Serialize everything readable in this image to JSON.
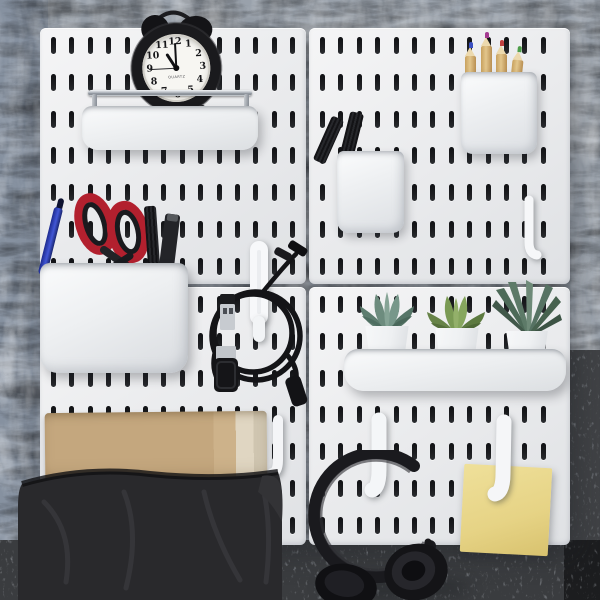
{
  "meta": {
    "title": "White pegboard wall organizer — styled product photo",
    "scene": "2x2 white slotted pegboard panels mounted on a textured gray wall above a gray carpeted floor"
  },
  "palette": {
    "wall": "#99a1ab",
    "wallLeft": "#8691a0",
    "floor": "#83878d",
    "panel": "#ebecee",
    "panelHi": "#f5f5f6",
    "panelLo": "#dfe1e4",
    "slot": "#1d1e21",
    "chrome": "#aeb4bb",
    "scissorRed": "#b2202e",
    "penBlue": "#2c3db0",
    "kraft": "#c4a77e",
    "bag": "#29292c",
    "note": "#e6d385",
    "plantGray": "#6d8c7e",
    "plantYellowGreen": "#7a9a54",
    "plantDark": "#4d6a58",
    "black": "#17181b",
    "white": "#f6f7f9"
  },
  "clock": {
    "numerals": [
      "12",
      "1",
      "2",
      "3",
      "4",
      "5",
      "6",
      "7",
      "8",
      "9",
      "10",
      "11"
    ],
    "brand": "QUARTZ",
    "time": {
      "hour": 11,
      "minute": 0,
      "second": 45
    }
  },
  "objects": [
    {
      "id": "pegboard-panel",
      "label": "white slotted pegboard panel (x4)",
      "color": "#ebecee"
    },
    {
      "id": "alarm-clock",
      "label": "black twin-bell alarm clock reading ~11:00",
      "color": "#17181b"
    },
    {
      "id": "wall-shelf",
      "label": "white shelf with chrome guard rail under clock",
      "color": "#f6f7f9"
    },
    {
      "id": "marker-cup",
      "label": "white cup holding two black markers",
      "color": "#f6f7f9"
    },
    {
      "id": "pencil-cup",
      "label": "white cup holding four wooden colored pencils",
      "color": "#f6f7f9"
    },
    {
      "id": "storage-bin",
      "label": "white bin with red-handled scissors, blue pen, black markers",
      "color": "#f6f7f9"
    },
    {
      "id": "usb-cable",
      "label": "coiled black USB cable on white hook with clip",
      "color": "#17181b"
    },
    {
      "id": "plant-shelf",
      "label": "white tray shelf with three potted succulents",
      "color": "#f6f7f9"
    },
    {
      "id": "white-hooks",
      "label": "white pegboard hooks (right panel, center, headphone, note)",
      "color": "#f6f7f9"
    },
    {
      "id": "kraft-envelope",
      "label": "kraft paper envelope",
      "color": "#c4a77e"
    },
    {
      "id": "fabric-bag",
      "label": "black fabric storage bag",
      "color": "#29292c"
    },
    {
      "id": "headphones",
      "label": "black over-ear headphones hanging from hook",
      "color": "#17181b"
    },
    {
      "id": "sticky-note",
      "label": "yellow sticky note clipped under white hook",
      "color": "#e6d385"
    }
  ]
}
